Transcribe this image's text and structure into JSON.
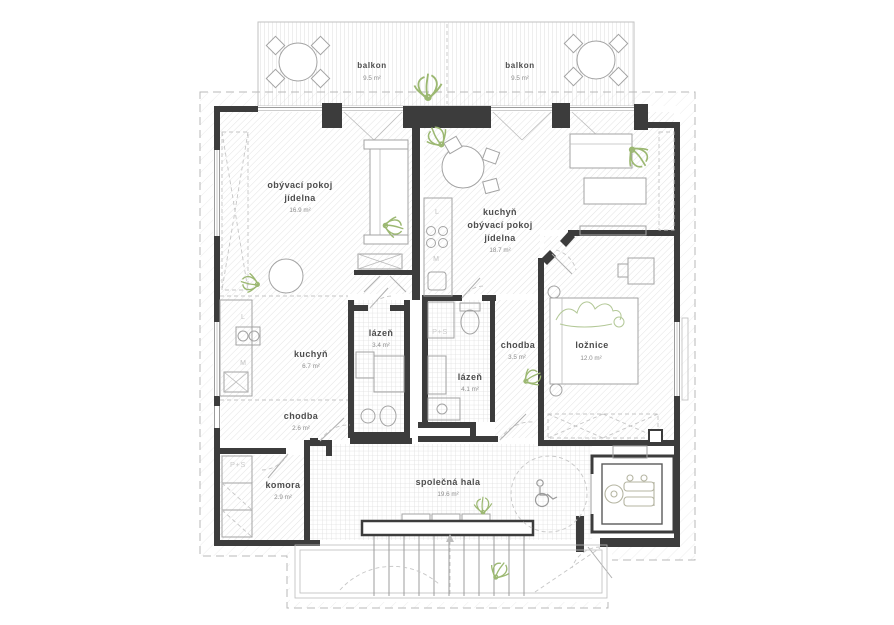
{
  "drawing": {
    "type": "residential floor plan",
    "language": "cs"
  },
  "rooms": {
    "balcony_left": {
      "name": "balkon",
      "area": "9.5 m²"
    },
    "balcony_right": {
      "name": "balkon",
      "area": "9.5 m²"
    },
    "living_dining_left": {
      "line1": "obývací pokoj",
      "line2": "jídelna",
      "area": "16.9 m²"
    },
    "kitchen_living_dining_right": {
      "line1": "kuchyň",
      "line2": "obývací pokoj",
      "line3": "jídelna",
      "area": "18.7 m²"
    },
    "kitchen_left": {
      "name": "kuchyň",
      "area": "6.7 m²"
    },
    "bathroom_left": {
      "name": "lázeň",
      "area": "3.4 m²"
    },
    "bathroom_right": {
      "name": "lázeň",
      "area": "4.1 m²"
    },
    "hallway_left": {
      "name": "chodba",
      "area": "2.6 m²"
    },
    "hallway_right": {
      "name": "chodba",
      "area": "3.5 m²"
    },
    "bedroom": {
      "name": "ložnice",
      "area": "12.0 m²"
    },
    "storage": {
      "name": "komora",
      "area": "2.9 m²"
    },
    "common_hall": {
      "name": "společná hala",
      "area": "19.6 m²"
    }
  },
  "appliance_labels": {
    "fridge_left": "L",
    "dishwasher_left": "M",
    "fridge_right": "L",
    "dishwasher_right": "M",
    "washer_dryer_bathroom": "P+S",
    "washer_dryer_storage": "P+S"
  },
  "colors": {
    "wall": "#3c3c3c",
    "thin_line": "#9c9c9c",
    "hatch": "#e2e2e2",
    "room_label": "#4d4d4d",
    "area_label": "#8c8c8c",
    "appliance_label": "#c2c2c2",
    "plant_green": "#9cb872"
  }
}
